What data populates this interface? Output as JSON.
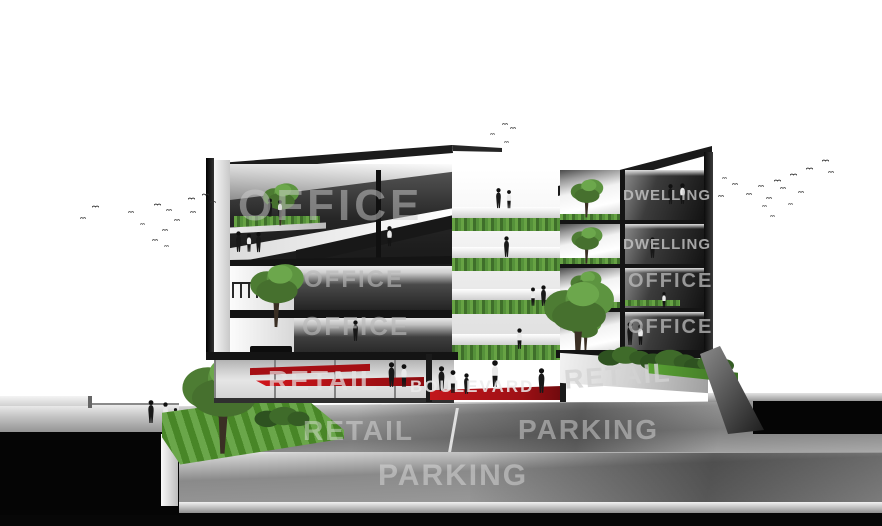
{
  "labels": {
    "left_tower": {
      "top_office": "OFFICE",
      "mid_office": "OFFICE",
      "lower_office": "OFFICE"
    },
    "right_tower": {
      "dwelling_upper": "DWELLING",
      "dwelling_lower": "DWELLING",
      "office_upper": "OFFICE",
      "office_lower": "OFFICE"
    },
    "ground": {
      "retail_left": "RETAIL",
      "boulevard": "BOULEVARD",
      "retail_right": "RETAIL"
    },
    "basement1": {
      "retail": "RETAIL",
      "parking": "PARKING"
    },
    "basement2": {
      "parking": "PARKING"
    }
  },
  "colors": {
    "background": "#ffffff",
    "structure_dark": "#141414",
    "interior_dark": "#2e2e2e",
    "label_text": "#dcdcdc",
    "grass_green": "#52982c",
    "foliage_green": "#4d7c33",
    "boulevard_red": "#c0161c",
    "concrete_gray": "#9a9a9a",
    "earth_black": "#050505"
  },
  "icons": {
    "tree": "tree-icon",
    "bush": "hedge-icon",
    "person": "person-icon",
    "bird": "bird-icon"
  }
}
